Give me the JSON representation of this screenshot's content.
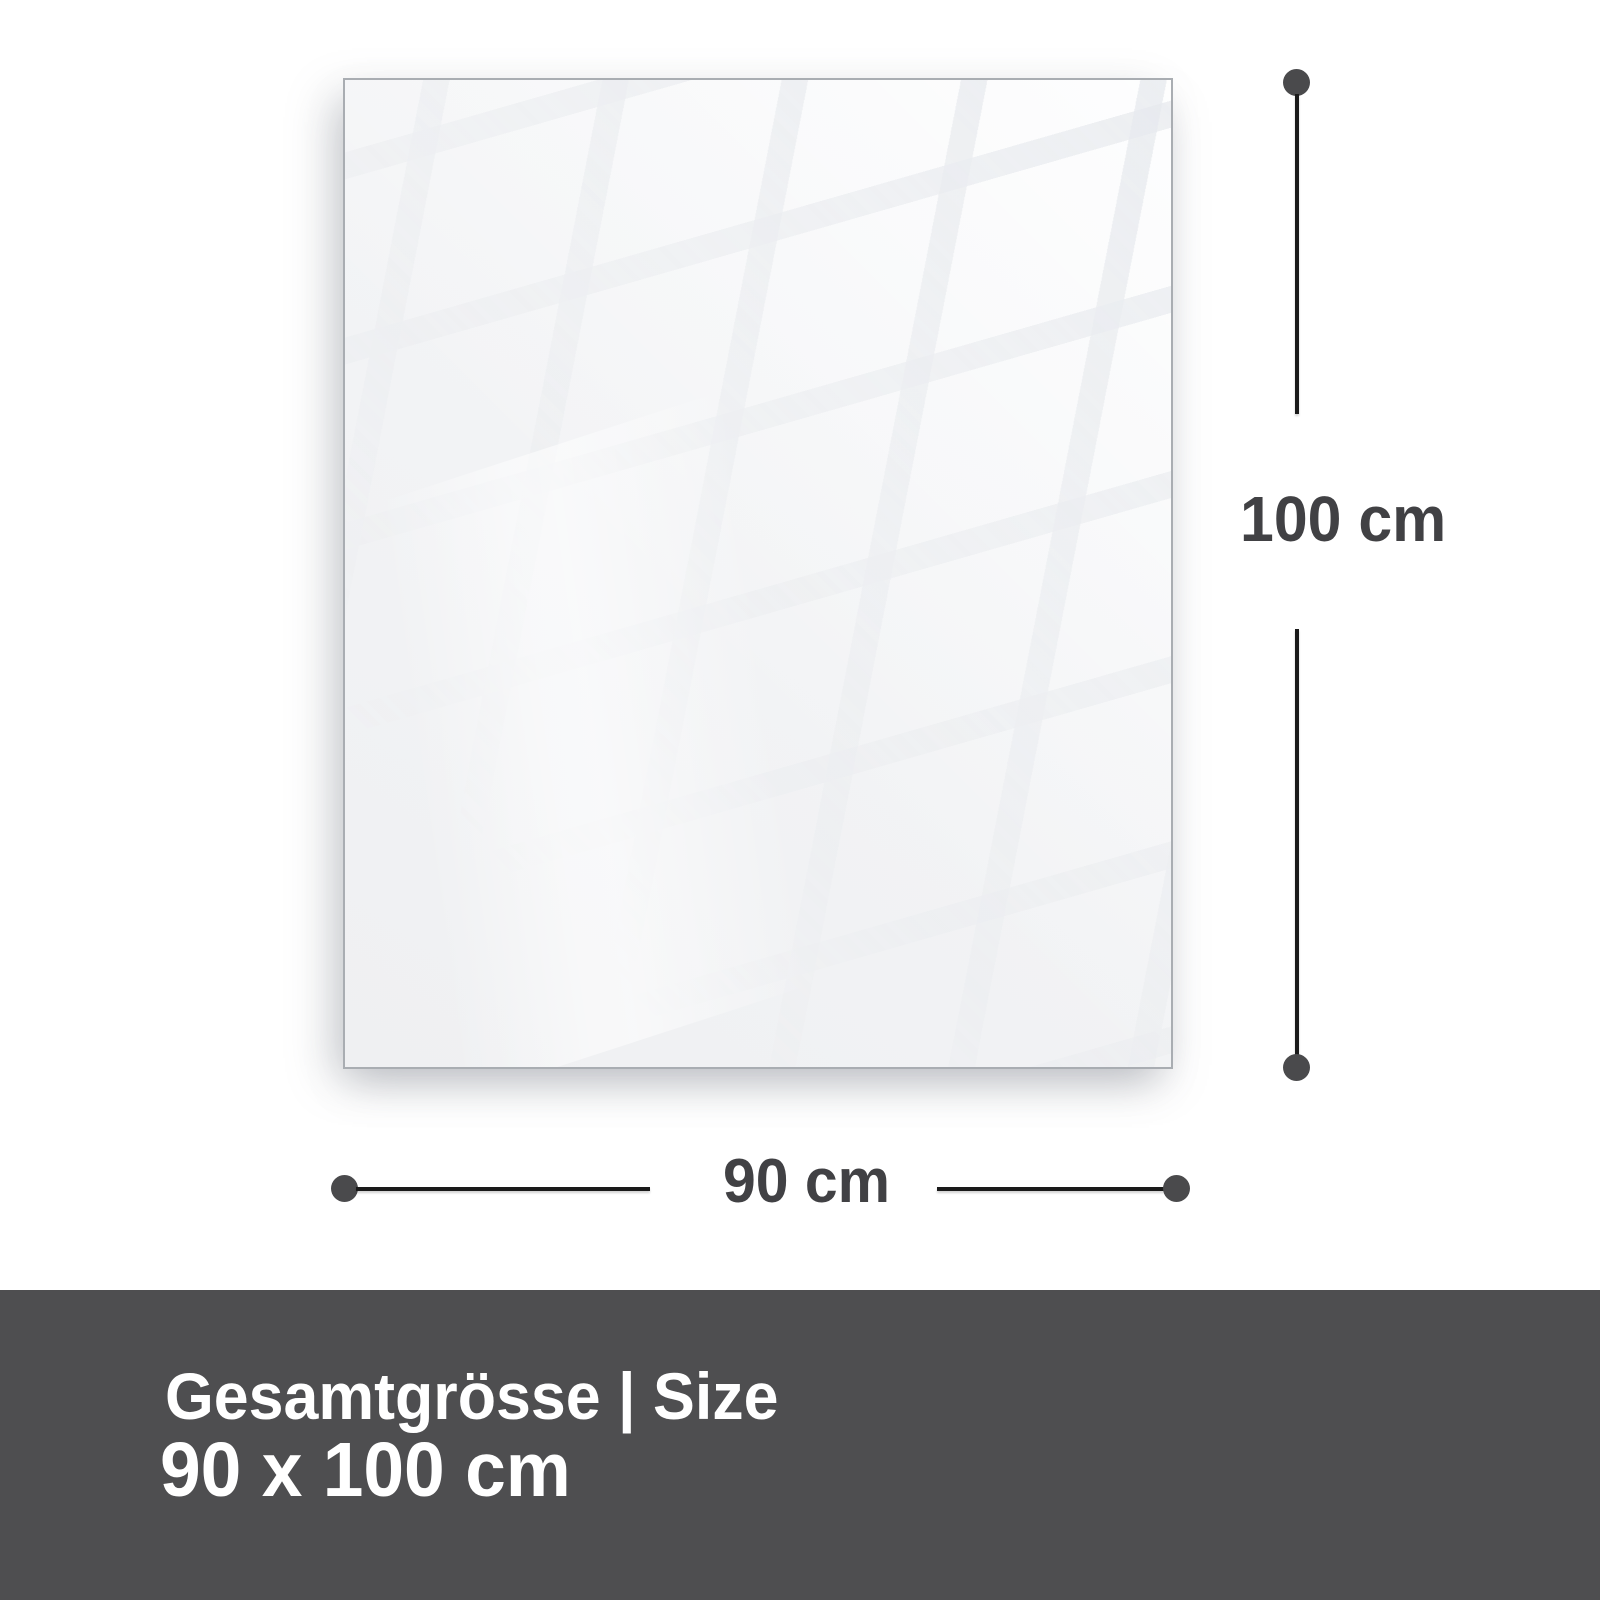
{
  "diagram": {
    "height_label": "100 cm",
    "width_label": "90 cm"
  },
  "footer": {
    "title": "Gesamtgrösse | Size",
    "value": "90 x 100 cm"
  },
  "colors": {
    "footer_bg": "#4e4e50",
    "footer_text": "#ffffff",
    "dimension_line": "#1a1a1a",
    "dimension_dot": "#4a4a4c",
    "dimension_label": "#414144",
    "panel_border": "#a9adb2",
    "panel_fill": "#f2f3f5"
  }
}
